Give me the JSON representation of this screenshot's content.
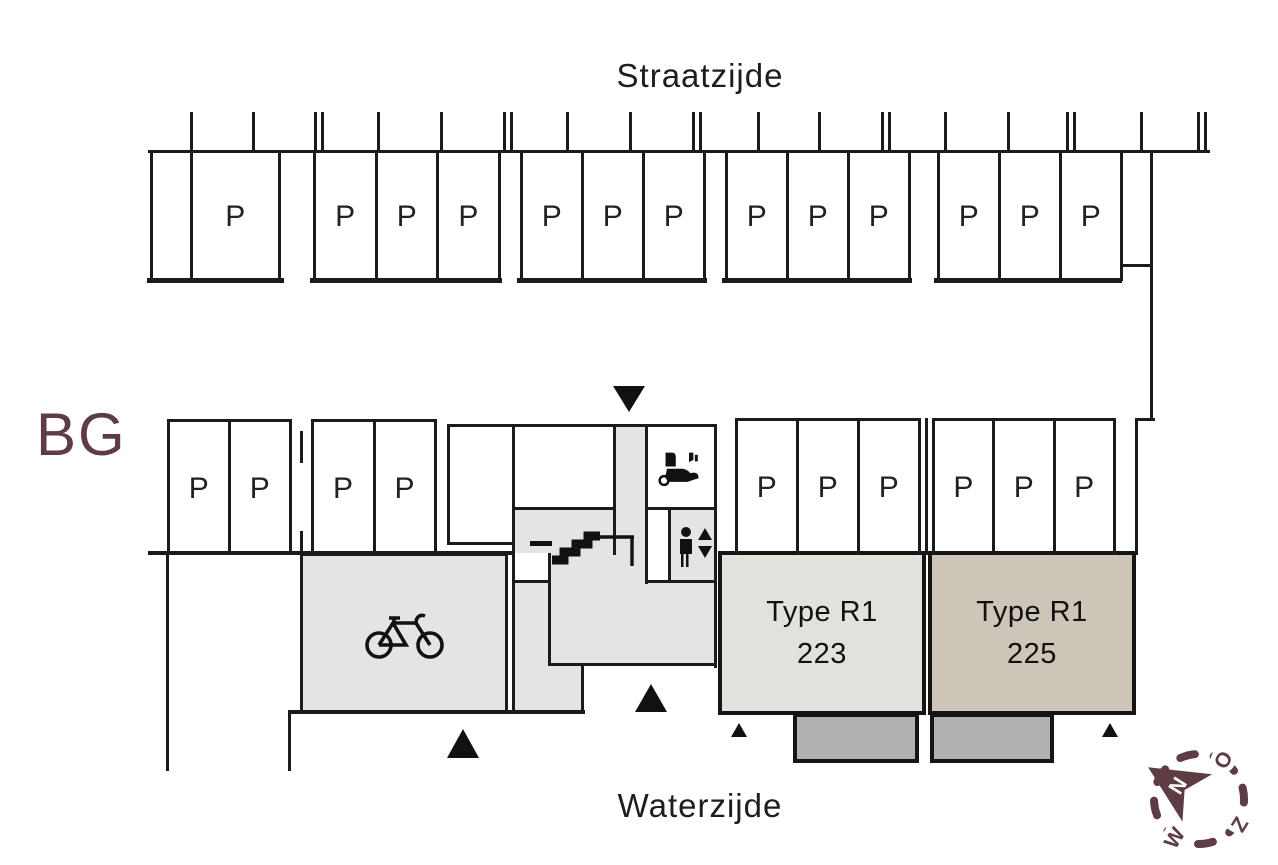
{
  "plan": {
    "floor_label": "BG",
    "street_label": "Straatzijde",
    "water_label": "Waterzijde",
    "parking_space_label": "P",
    "parking_counts": {
      "top_row_groups": [
        1,
        3,
        3,
        3,
        3
      ],
      "middle_row_groups": [
        2,
        2
      ],
      "right_row_groups": [
        3,
        3
      ],
      "total_spaces": 23
    },
    "units": [
      {
        "type_label": "Type R1",
        "number": "223"
      },
      {
        "type_label": "Type R1",
        "number": "225"
      }
    ],
    "compass": {
      "north": "N",
      "east": "O",
      "south": "Z",
      "west": "W"
    },
    "icons": {
      "bicycle": "bicycle-icon",
      "mobility_scooter": "mobility-scooter-icon",
      "elevator": "elevator-icon",
      "stairs": "stairs-icon",
      "entrances": "entrance-triangle"
    },
    "colors": {
      "wall": "#1b1b1b",
      "room_gray": "#e4e4e4",
      "unit_223_fill": "#e3e1dc",
      "unit_225_fill": "#cdc5b7",
      "terrace_fill": "#b1b1b1",
      "accent_maroon": "#5d3c43"
    }
  }
}
